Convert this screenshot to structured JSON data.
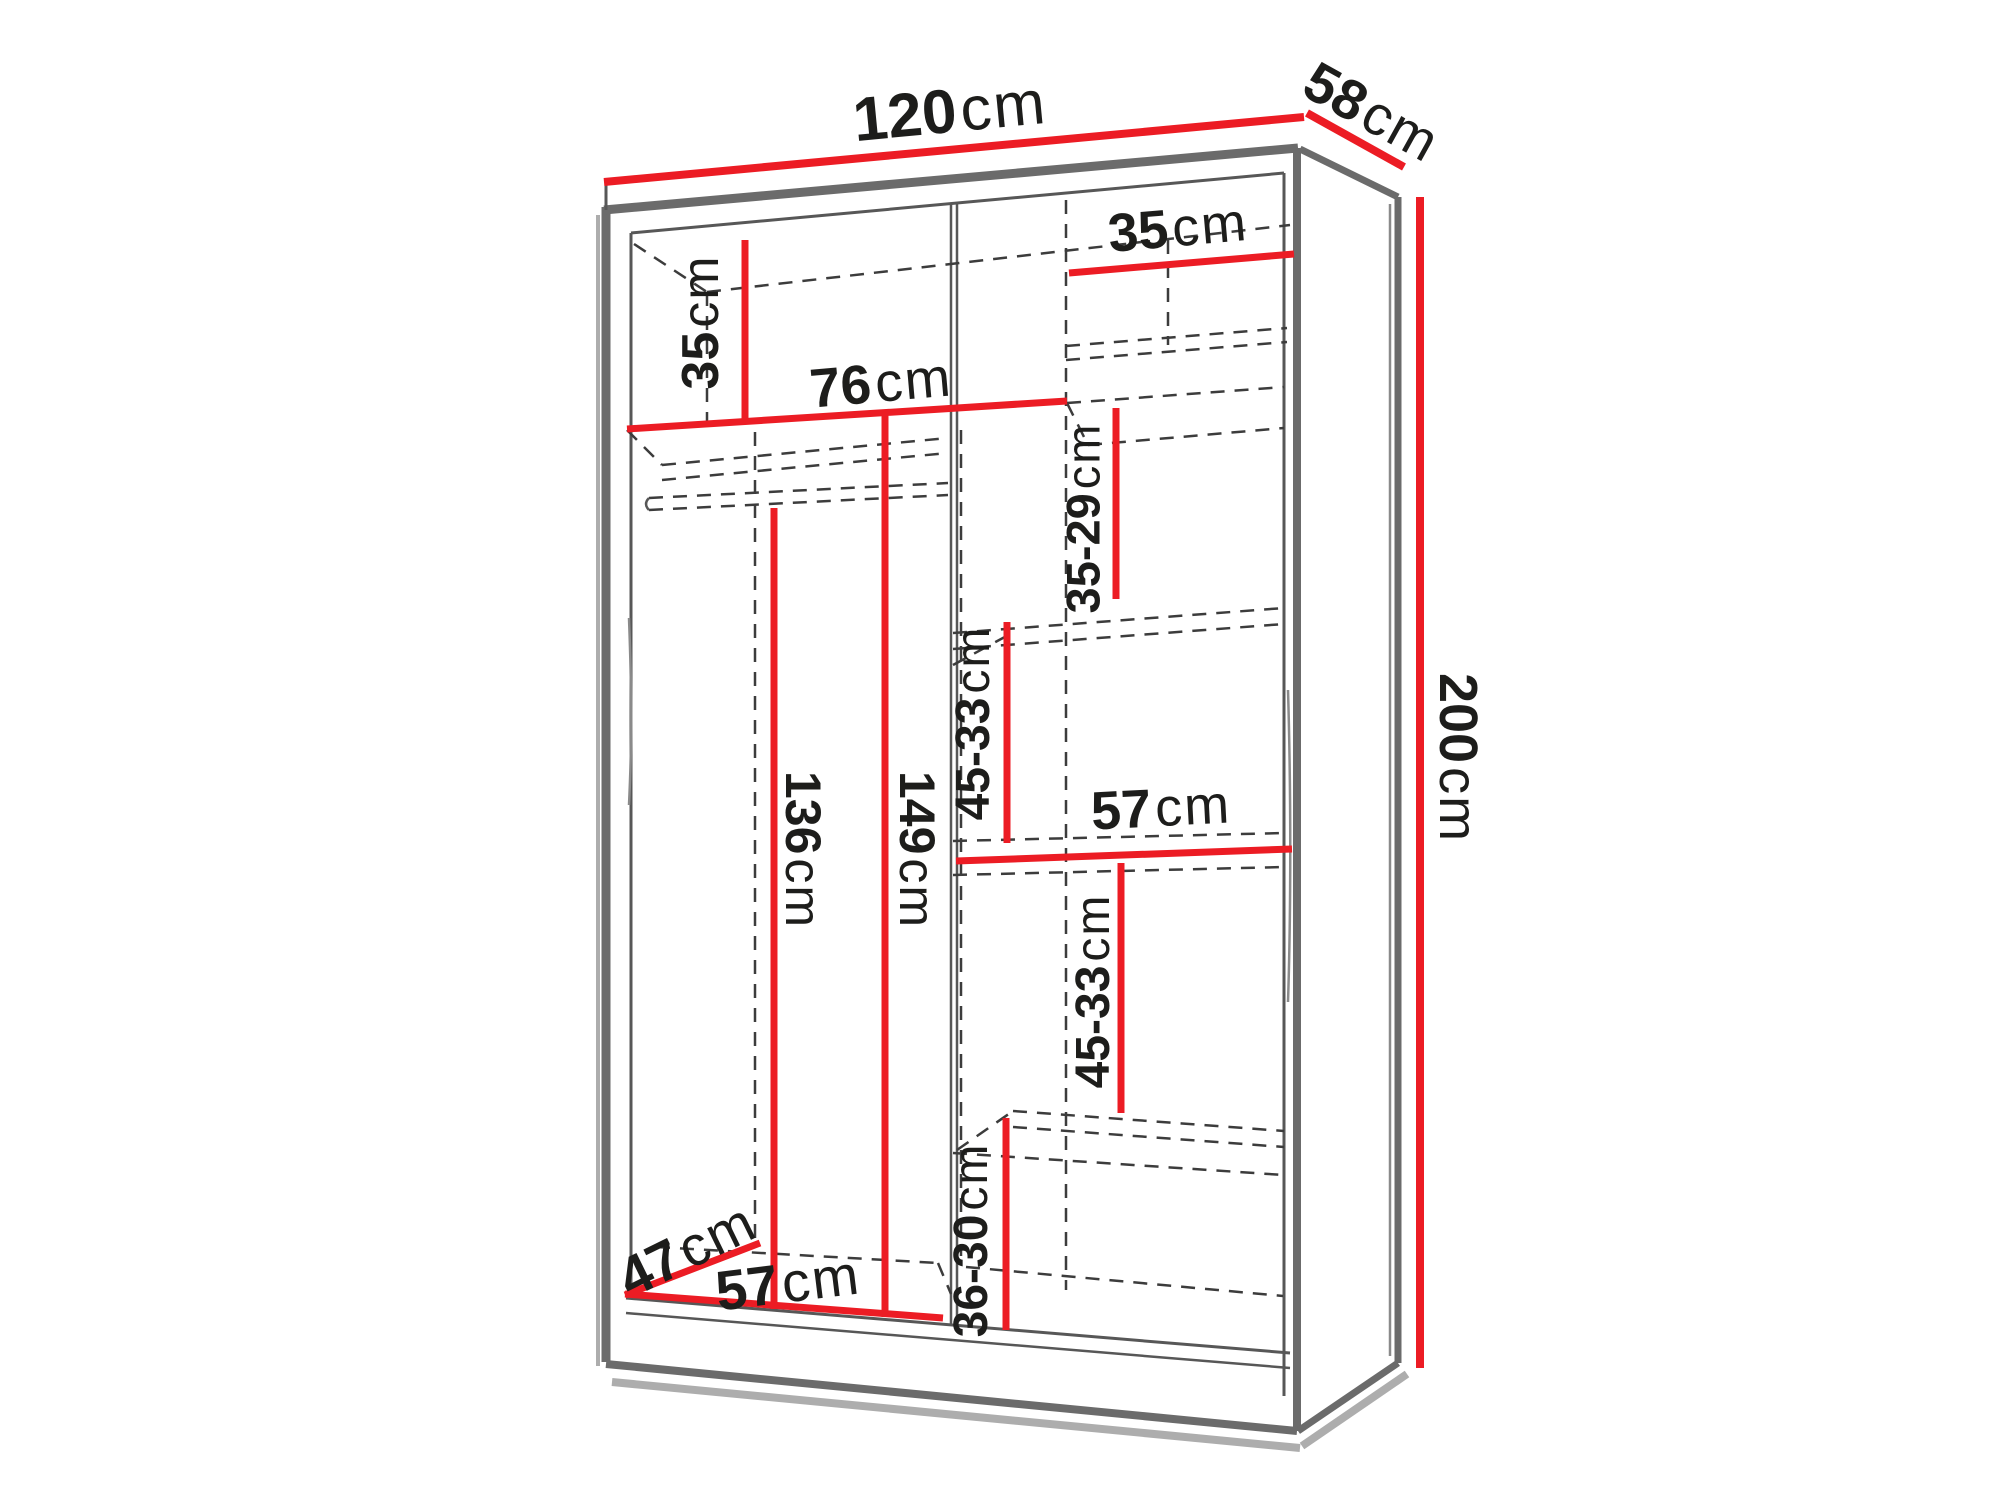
{
  "diagram": {
    "kind": "furniture-dimension-diagram",
    "subject": "wardrobe interior dimensions, perspective view",
    "unit": "cm",
    "overall": {
      "width_cm": "120",
      "depth_cm": "58",
      "height_cm": "200"
    }
  },
  "colors": {
    "dimension_line": "#ec1c24",
    "structure_gray": "#6b6b6b",
    "hidden_edge_gray": "#3c3c3c",
    "label_text": "#1d1d1b",
    "background": "#ffffff"
  },
  "labels": [
    {
      "id": "width-top",
      "value": "120",
      "unit": "cm"
    },
    {
      "id": "depth-top",
      "value": "58",
      "unit": "cm"
    },
    {
      "id": "height-right",
      "value": "200",
      "unit": "cm"
    },
    {
      "id": "left-top-shelf-height",
      "value": "35",
      "unit": "cm"
    },
    {
      "id": "left-shelf-width",
      "value": "76",
      "unit": "cm"
    },
    {
      "id": "right-top-shelf-width",
      "value": "35",
      "unit": "cm"
    },
    {
      "id": "right-upper-compartment-height",
      "value": "35-29",
      "unit": "cm"
    },
    {
      "id": "right-middle-compartment-height",
      "value": "45-33",
      "unit": "cm"
    },
    {
      "id": "right-shelf-width",
      "value": "57",
      "unit": "cm"
    },
    {
      "id": "right-lower-compartment-height",
      "value": "45-33",
      "unit": "cm"
    },
    {
      "id": "right-bottom-compartment-height",
      "value": "36-30",
      "unit": "cm"
    },
    {
      "id": "left-hanging-height",
      "value": "136",
      "unit": "cm"
    },
    {
      "id": "left-interior-height",
      "value": "149",
      "unit": "cm"
    },
    {
      "id": "bottom-width",
      "value": "57",
      "unit": "cm"
    },
    {
      "id": "bottom-depth",
      "value": "47",
      "unit": "cm"
    }
  ]
}
